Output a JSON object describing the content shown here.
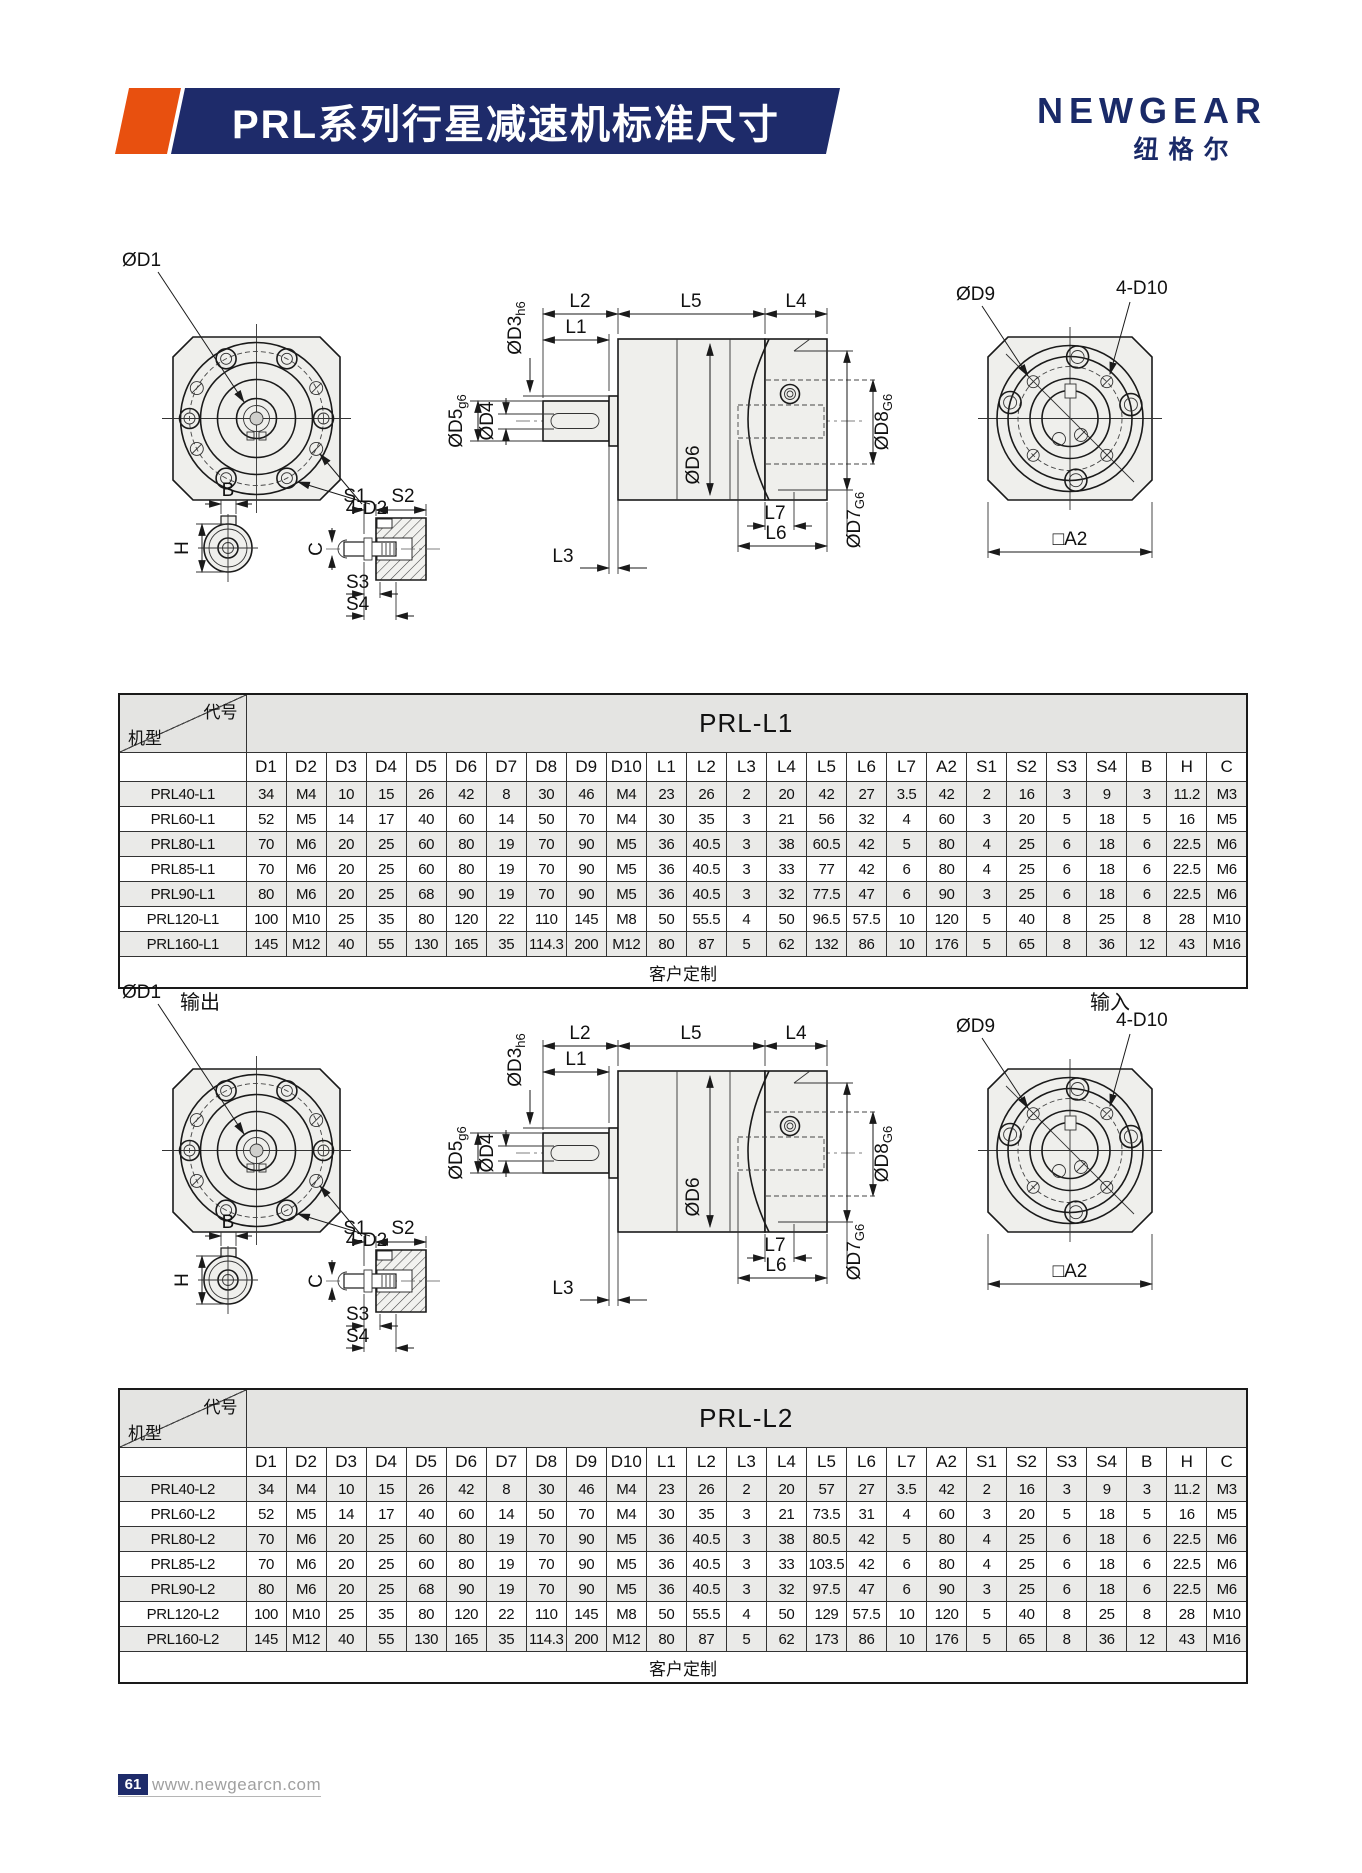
{
  "header": {
    "title": "PRL系列行星减速机标准尺寸",
    "brand": "NEWGEAR",
    "brand_cn": "纽格尔",
    "accent_color": "#e8500f",
    "navy": "#1e2b6a"
  },
  "drawing": {
    "od1": "ØD1",
    "d2_holes": "4-D2",
    "od3": {
      "main": "ØD3",
      "sub": "h6"
    },
    "od4": "ØD4",
    "od5": {
      "main": "ØD5",
      "sub": "g6"
    },
    "od6": "ØD6",
    "od7": {
      "main": "ØD7",
      "sub": "G6"
    },
    "od8": {
      "main": "ØD8",
      "sub": "G6"
    },
    "od9": "ØD9",
    "d10_holes": "4-D10",
    "a2": "□A2",
    "l1": "L1",
    "l2": "L2",
    "l3": "L3",
    "l4": "L4",
    "l5": "L5",
    "l6": "L6",
    "l7": "L7",
    "s1": "S1",
    "s2": "S2",
    "s3": "S3",
    "s4": "S4",
    "b": "B",
    "h": "H",
    "c": "C",
    "output": "输出",
    "input": "输入"
  },
  "tables": [
    {
      "corner_top": "代号",
      "corner_bottom": "机型",
      "series": "PRL-L1",
      "columns": [
        "D1",
        "D2",
        "D3",
        "D4",
        "D5",
        "D6",
        "D7",
        "D8",
        "D9",
        "D10",
        "L1",
        "L2",
        "L3",
        "L4",
        "L5",
        "L6",
        "L7",
        "A2",
        "S1",
        "S2",
        "S3",
        "S4",
        "B",
        "H",
        "C"
      ],
      "rows": [
        {
          "model": "PRL40-L1",
          "values": [
            "34",
            "M4",
            "10",
            "15",
            "26",
            "42",
            "8",
            "30",
            "46",
            "M4",
            "23",
            "26",
            "2",
            "20",
            "42",
            "27",
            "3.5",
            "42",
            "2",
            "16",
            "3",
            "9",
            "3",
            "11.2",
            "M3"
          ]
        },
        {
          "model": "PRL60-L1",
          "values": [
            "52",
            "M5",
            "14",
            "17",
            "40",
            "60",
            "14",
            "50",
            "70",
            "M4",
            "30",
            "35",
            "3",
            "21",
            "56",
            "32",
            "4",
            "60",
            "3",
            "20",
            "5",
            "18",
            "5",
            "16",
            "M5"
          ]
        },
        {
          "model": "PRL80-L1",
          "values": [
            "70",
            "M6",
            "20",
            "25",
            "60",
            "80",
            "19",
            "70",
            "90",
            "M5",
            "36",
            "40.5",
            "3",
            "38",
            "60.5",
            "42",
            "5",
            "80",
            "4",
            "25",
            "6",
            "18",
            "6",
            "22.5",
            "M6"
          ]
        },
        {
          "model": "PRL85-L1",
          "values": [
            "70",
            "M6",
            "20",
            "25",
            "60",
            "80",
            "19",
            "70",
            "90",
            "M5",
            "36",
            "40.5",
            "3",
            "33",
            "77",
            "42",
            "6",
            "80",
            "4",
            "25",
            "6",
            "18",
            "6",
            "22.5",
            "M6"
          ]
        },
        {
          "model": "PRL90-L1",
          "values": [
            "80",
            "M6",
            "20",
            "25",
            "68",
            "90",
            "19",
            "70",
            "90",
            "M5",
            "36",
            "40.5",
            "3",
            "32",
            "77.5",
            "47",
            "6",
            "90",
            "3",
            "25",
            "6",
            "18",
            "6",
            "22.5",
            "M6"
          ]
        },
        {
          "model": "PRL120-L1",
          "values": [
            "100",
            "M10",
            "25",
            "35",
            "80",
            "120",
            "22",
            "110",
            "145",
            "M8",
            "50",
            "55.5",
            "4",
            "50",
            "96.5",
            "57.5",
            "10",
            "120",
            "5",
            "40",
            "8",
            "25",
            "8",
            "28",
            "M10"
          ]
        },
        {
          "model": "PRL160-L1",
          "values": [
            "145",
            "M12",
            "40",
            "55",
            "130",
            "165",
            "35",
            "114.3",
            "200",
            "M12",
            "80",
            "87",
            "5",
            "62",
            "132",
            "86",
            "10",
            "176",
            "5",
            "65",
            "8",
            "36",
            "12",
            "43",
            "M16"
          ]
        }
      ],
      "footer": "客户定制"
    },
    {
      "corner_top": "代号",
      "corner_bottom": "机型",
      "series": "PRL-L2",
      "columns": [
        "D1",
        "D2",
        "D3",
        "D4",
        "D5",
        "D6",
        "D7",
        "D8",
        "D9",
        "D10",
        "L1",
        "L2",
        "L3",
        "L4",
        "L5",
        "L6",
        "L7",
        "A2",
        "S1",
        "S2",
        "S3",
        "S4",
        "B",
        "H",
        "C"
      ],
      "rows": [
        {
          "model": "PRL40-L2",
          "values": [
            "34",
            "M4",
            "10",
            "15",
            "26",
            "42",
            "8",
            "30",
            "46",
            "M4",
            "23",
            "26",
            "2",
            "20",
            "57",
            "27",
            "3.5",
            "42",
            "2",
            "16",
            "3",
            "9",
            "3",
            "11.2",
            "M3"
          ]
        },
        {
          "model": "PRL60-L2",
          "values": [
            "52",
            "M5",
            "14",
            "17",
            "40",
            "60",
            "14",
            "50",
            "70",
            "M4",
            "30",
            "35",
            "3",
            "21",
            "73.5",
            "31",
            "4",
            "60",
            "3",
            "20",
            "5",
            "18",
            "5",
            "16",
            "M5"
          ]
        },
        {
          "model": "PRL80-L2",
          "values": [
            "70",
            "M6",
            "20",
            "25",
            "60",
            "80",
            "19",
            "70",
            "90",
            "M5",
            "36",
            "40.5",
            "3",
            "38",
            "80.5",
            "42",
            "5",
            "80",
            "4",
            "25",
            "6",
            "18",
            "6",
            "22.5",
            "M6"
          ]
        },
        {
          "model": "PRL85-L2",
          "values": [
            "70",
            "M6",
            "20",
            "25",
            "60",
            "80",
            "19",
            "70",
            "90",
            "M5",
            "36",
            "40.5",
            "3",
            "33",
            "103.5",
            "42",
            "6",
            "80",
            "4",
            "25",
            "6",
            "18",
            "6",
            "22.5",
            "M6"
          ]
        },
        {
          "model": "PRL90-L2",
          "values": [
            "80",
            "M6",
            "20",
            "25",
            "68",
            "90",
            "19",
            "70",
            "90",
            "M5",
            "36",
            "40.5",
            "3",
            "32",
            "97.5",
            "47",
            "6",
            "90",
            "3",
            "25",
            "6",
            "18",
            "6",
            "22.5",
            "M6"
          ]
        },
        {
          "model": "PRL120-L2",
          "values": [
            "100",
            "M10",
            "25",
            "35",
            "80",
            "120",
            "22",
            "110",
            "145",
            "M8",
            "50",
            "55.5",
            "4",
            "50",
            "129",
            "57.5",
            "10",
            "120",
            "5",
            "40",
            "8",
            "25",
            "8",
            "28",
            "M10"
          ]
        },
        {
          "model": "PRL160-L2",
          "values": [
            "145",
            "M12",
            "40",
            "55",
            "130",
            "165",
            "35",
            "114.3",
            "200",
            "M12",
            "80",
            "87",
            "5",
            "62",
            "173",
            "86",
            "10",
            "176",
            "5",
            "65",
            "8",
            "36",
            "12",
            "43",
            "M16"
          ]
        }
      ],
      "footer": "客户定制"
    }
  ],
  "page_footer": {
    "page_num": "61",
    "site": "www.newgearcn.com"
  }
}
